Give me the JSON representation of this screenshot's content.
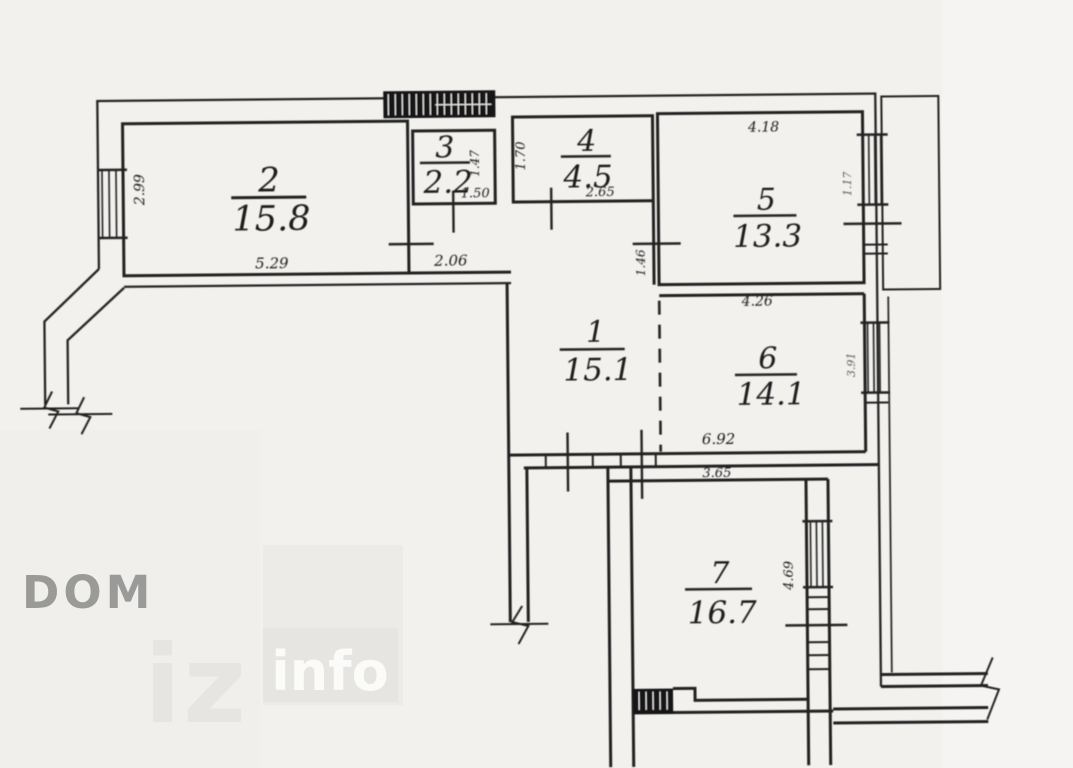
{
  "watermarks": {
    "dom": "DOM",
    "iz": "iz",
    "info": "info"
  },
  "plan": {
    "rooms": [
      {
        "number": "1",
        "area": "15.1"
      },
      {
        "number": "2",
        "area": "15.8"
      },
      {
        "number": "3",
        "area": "2.2"
      },
      {
        "number": "4",
        "area": "4.5"
      },
      {
        "number": "5",
        "area": "13.3"
      },
      {
        "number": "6",
        "area": "14.1"
      },
      {
        "number": "7",
        "area": "16.7"
      }
    ],
    "dimensions": {
      "room2_depth": "2.99",
      "room2_width": "5.29",
      "hall_opening": "2.06",
      "room3_width": "1.50",
      "room3_depth": "1.47",
      "room4_depth": "1.70",
      "room4_width": "2.65",
      "room5_width": "4.18",
      "room5_window": "1.17",
      "room6_top_width": "4.26",
      "room5_door_wall": "1.46",
      "room6_window": "3.91",
      "room6_width": "6.92",
      "room7_width": "3.65",
      "room7_depth": "4.69"
    },
    "colors": {
      "ink": "#232323",
      "paper": "#f2f1ee",
      "watermark_gray": "#9a9a99",
      "watermark_light": "#e6e5e1"
    }
  }
}
